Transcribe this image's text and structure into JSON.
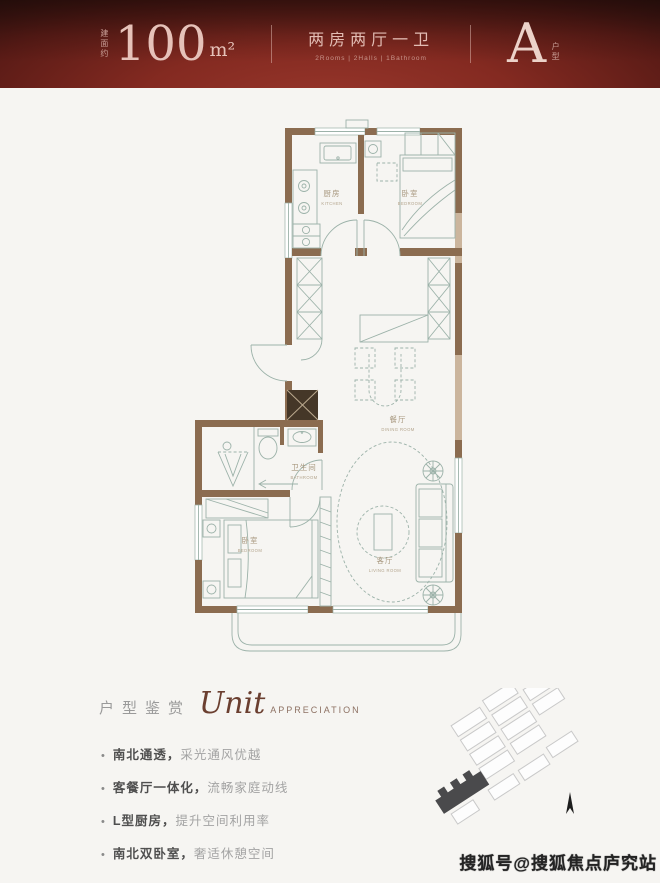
{
  "header": {
    "area_prefix": "建面约",
    "area_value": "100",
    "area_unit": "m²",
    "layout_zh": "两房两厅一卫",
    "layout_en": "2Rooms | 2Halls | 1Bathroom",
    "unit_letter": "A",
    "unit_suffix": "户型"
  },
  "floorplan": {
    "rooms": [
      {
        "zh": "厨房",
        "en": "KITCHEN"
      },
      {
        "zh": "卧室",
        "en": "BEDROOM"
      },
      {
        "zh": "餐厅",
        "en": "DINING ROOM"
      },
      {
        "zh": "卫生间",
        "en": "BATHROOM"
      },
      {
        "zh": "卧室",
        "en": "BEDROOM"
      },
      {
        "zh": "客厅",
        "en": "LIVING ROOM"
      }
    ]
  },
  "appreciation": {
    "title_zh": "户型鉴赏",
    "title_script": "Unit",
    "title_en": "APPRECIATION",
    "bullet": "•",
    "bullets": [
      {
        "bold": "南北通透，",
        "text": "采光通风优越"
      },
      {
        "bold": "客餐厅一体化，",
        "text": "流畅家庭动线"
      },
      {
        "bold": "L型厨房，",
        "text": "提升空间利用率"
      },
      {
        "bold": "南北双卧室，",
        "text": "奢适休憩空间"
      }
    ]
  },
  "watermark": "搜狐号@搜狐焦点庐究站",
  "colors": {
    "banner_red": "#8a2b22",
    "banner_text": "#e6c2b9",
    "wall_brown": "#8b6c50",
    "wall_tan": "#cbb59d",
    "plan_line": "#9cb2a9",
    "label_tan": "#a8987f",
    "script_brown": "#6b3f30",
    "site_highlight": "#4a4a4c"
  }
}
